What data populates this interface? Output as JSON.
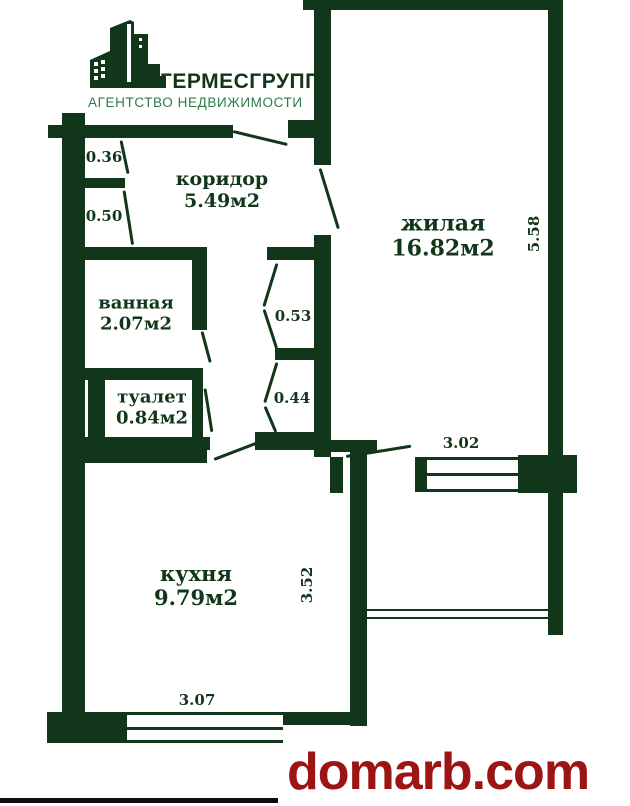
{
  "branding": {
    "logo_title": "ГЕРМЕСГРУПП",
    "logo_subtitle": "АГЕНТСТВО НЕДВИЖИМОСТИ"
  },
  "watermark": {
    "text": "domarb.com",
    "color": "#9c1413"
  },
  "colors": {
    "wall": "#12361a",
    "subtitle_green": "#2e7b45"
  },
  "rooms": {
    "corridor": {
      "name": "коридор",
      "area": "5.49м2"
    },
    "living": {
      "name": "жилая",
      "area": "16.82м2"
    },
    "bathroom": {
      "name": "ванная",
      "area": "2.07м2"
    },
    "toilet": {
      "name": "туалет",
      "area": "0.84м2"
    },
    "kitchen": {
      "name": "кухня",
      "area": "9.79м2"
    }
  },
  "dims": {
    "d036": "0.36",
    "d050": "0.50",
    "d053": "0.53",
    "d044": "0.44",
    "d558": "5.58",
    "d302": "3.02",
    "d352": "3.52",
    "d307": "3.07"
  }
}
